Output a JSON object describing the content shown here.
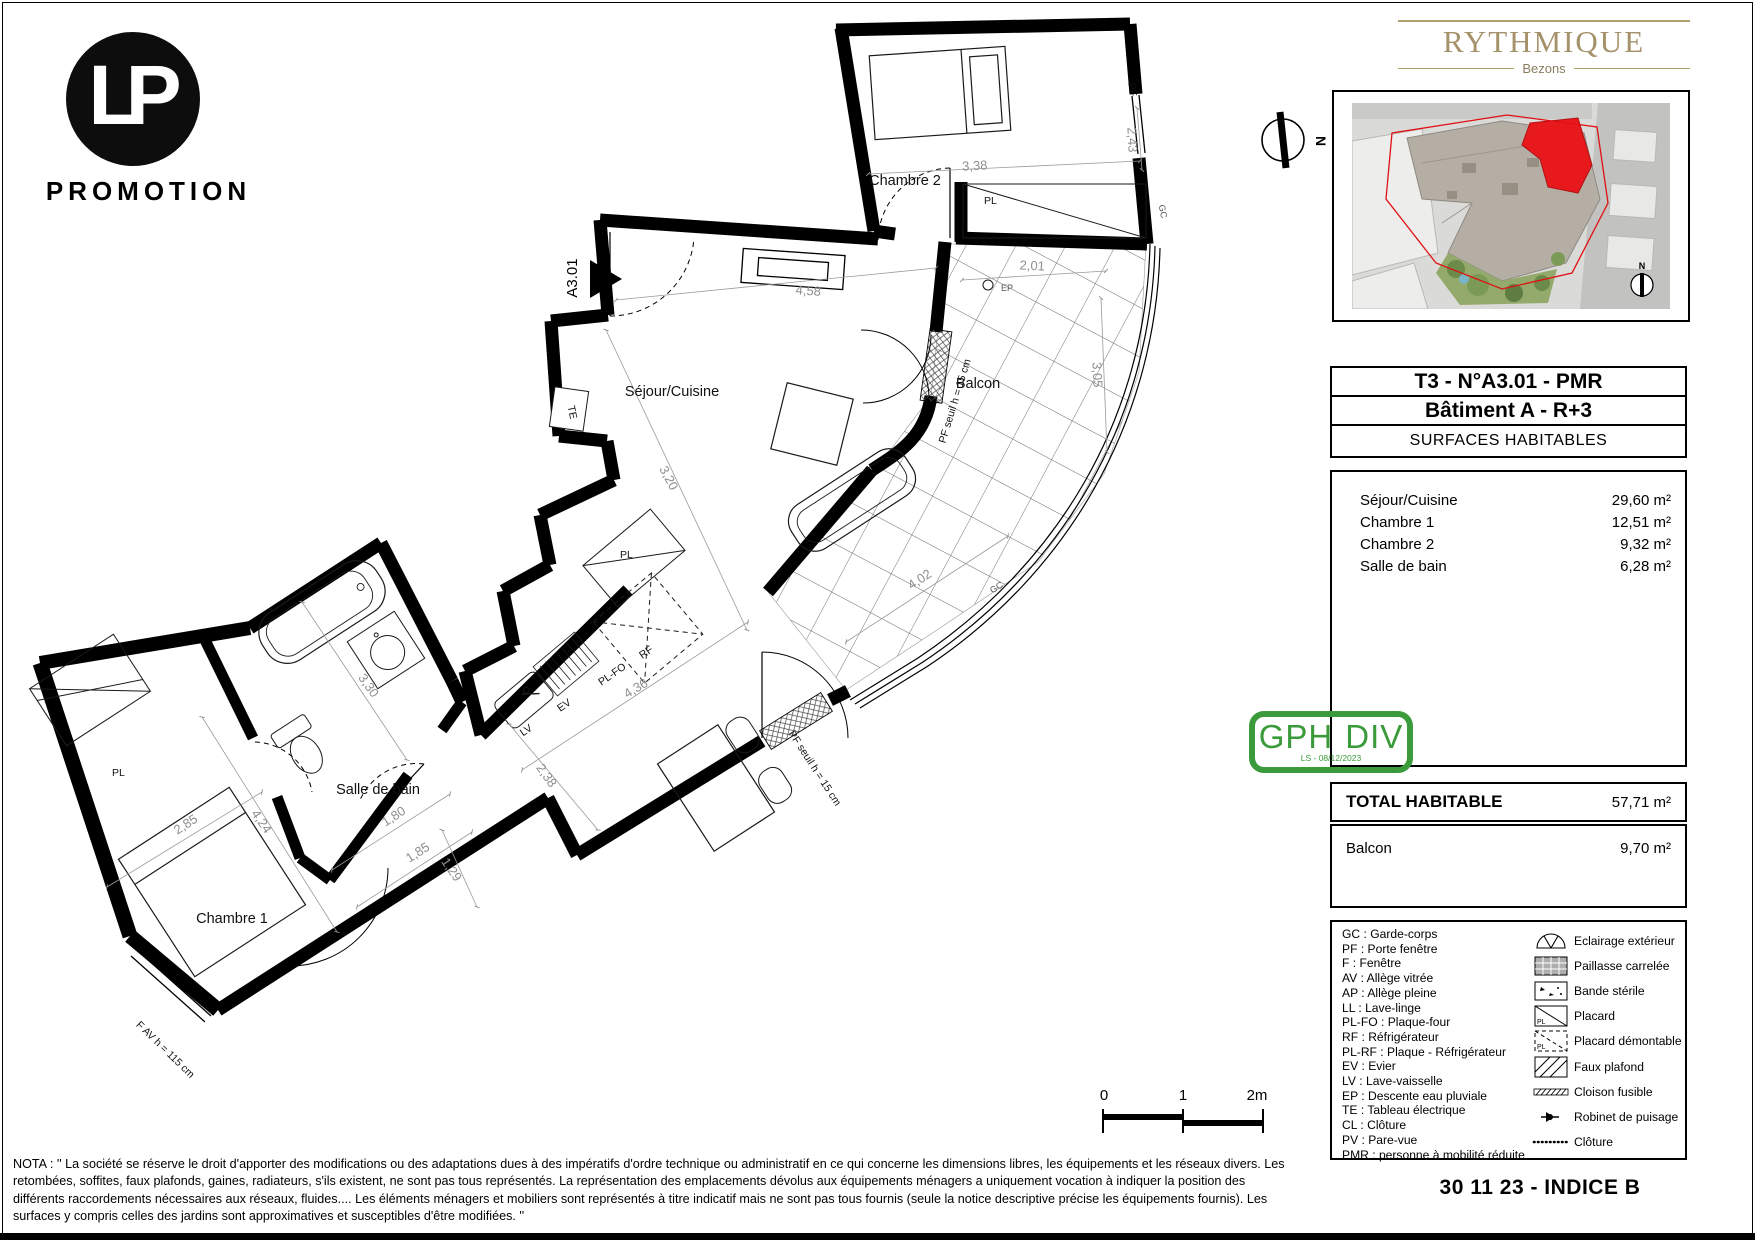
{
  "branding": {
    "lp_monogram": "LP",
    "lp_label": "PROMOTION",
    "program_name": "RYTHMIQUE",
    "program_city": "Bezons"
  },
  "title_block": {
    "unit": "T3 - N°A3.01 - PMR",
    "building": "Bâtiment A - R+3",
    "header": "SURFACES HABITABLES"
  },
  "surfaces": [
    {
      "label": "Séjour/Cuisine",
      "value": "29,60 m²"
    },
    {
      "label": "Chambre 1",
      "value": "12,51 m²"
    },
    {
      "label": "Chambre 2",
      "value": "9,32 m²"
    },
    {
      "label": "Salle de bain",
      "value": "6,28 m²"
    }
  ],
  "totals": {
    "total_label": "TOTAL HABITABLE",
    "total_value": "57,71 m²",
    "balcony_label": "Balcon",
    "balcony_value": "9,70 m²"
  },
  "stamp": {
    "left": "GPH",
    "right": "DIV",
    "sub": "LS - 08/12/2023",
    "color": "#3b9b3b"
  },
  "legend": {
    "abbreviations": [
      "GC : Garde-corps",
      "PF : Porte fenêtre",
      "F : Fenêtre",
      "AV : Allège vitrée",
      "AP : Allège pleine",
      "LL : Lave-linge",
      "PL-FO : Plaque-four",
      "RF : Réfrigérateur",
      "PL-RF : Plaque - Réfrigérateur",
      "EV : Evier",
      "LV : Lave-vaisselle",
      "EP : Descente eau pluviale",
      "TE : Tableau électrique",
      "CL : Clôture",
      "PV : Pare-vue",
      "PMR : personne à mobilité réduite"
    ],
    "symbols": [
      {
        "icon": "eclairage-exterieur-icon",
        "label": "Eclairage extérieur"
      },
      {
        "icon": "paillasse-carrelee-icon",
        "label": "Paillasse carrelée"
      },
      {
        "icon": "bande-sterile-icon",
        "label": "Bande stérile"
      },
      {
        "icon": "placard-icon",
        "label": "Placard"
      },
      {
        "icon": "placard-demontable-icon",
        "label": "Placard démontable"
      },
      {
        "icon": "faux-plafond-icon",
        "label": "Faux plafond"
      },
      {
        "icon": "cloison-fusible-icon",
        "label": "Cloison fusible"
      },
      {
        "icon": "robinet-de-puisage-icon",
        "label": "Robinet de puisage"
      },
      {
        "icon": "cloture-icon",
        "label": "Clôture"
      }
    ]
  },
  "scale_bar": {
    "t0": "0",
    "t1": "1",
    "t2": "2m"
  },
  "compass": {
    "north": "N"
  },
  "footer": {
    "nota_lines": [
      "NOTA : '' La société se réserve le droit d'apporter des modifications ou des adaptations dues à des impératifs d'ordre technique ou administratif en ce qui concerne les dimensions libres, les équipements et les réseaux divers. Les",
      "retombées, soffites, faux plafonds, gaines, radiateurs, s'ils existent, ne sont pas tous représentés. La représentation des emplacements dévolus aux équipements ménagers a uniquement vocation à indiquer la position des",
      "différents raccordements nécessaires aux réseaux, fluides.... Les éléments ménagers et mobiliers sont représentés à titre indicatif mais ne sont pas tous fournis (seule la notice descriptive précise les équipements fournis). Les",
      "surfaces y compris celles des jardins sont approximatives et susceptibles d'être modifiées. ''"
    ],
    "date_index": "30 11 23 - INDICE B"
  },
  "colors": {
    "brand_gold": "#a5926a",
    "stamp_green": "#3b9b3b",
    "unit_red": "#e8191c"
  },
  "plan": {
    "rooms": {
      "chambre2": "Chambre 2",
      "sejour": "Séjour/Cuisine",
      "balcon": "Balcon",
      "sdb": "Salle de bain",
      "chambre1": "Chambre 1"
    },
    "dims": {
      "d338": "3,38",
      "d243": "2,43",
      "d458": "4,58",
      "d201": "2,01",
      "d305": "3,05",
      "d320": "3,20",
      "d402": "4,02",
      "d436": "4,36",
      "d238": "2,38",
      "d330": "3,30",
      "d180": "1,80",
      "d185": "1,85",
      "d129": "1,29",
      "d285": "2,85",
      "d424": "4,24"
    },
    "tags": {
      "a301": "A3.01",
      "pf": "PF",
      "gc1": "GC",
      "gc2": "GC",
      "ep": "EP",
      "te": "TE",
      "pl1": "PL",
      "pl2": "PL",
      "pl3": "PL",
      "rf": "RF",
      "plfo": "PL-FO",
      "ev": "EV",
      "lv": "LV",
      "pfseuil1": "PF seuil h = 15 cm",
      "pfseuil2": "PF seuil h = 15 cm",
      "fav": "F AV  h = 115 cm"
    }
  }
}
